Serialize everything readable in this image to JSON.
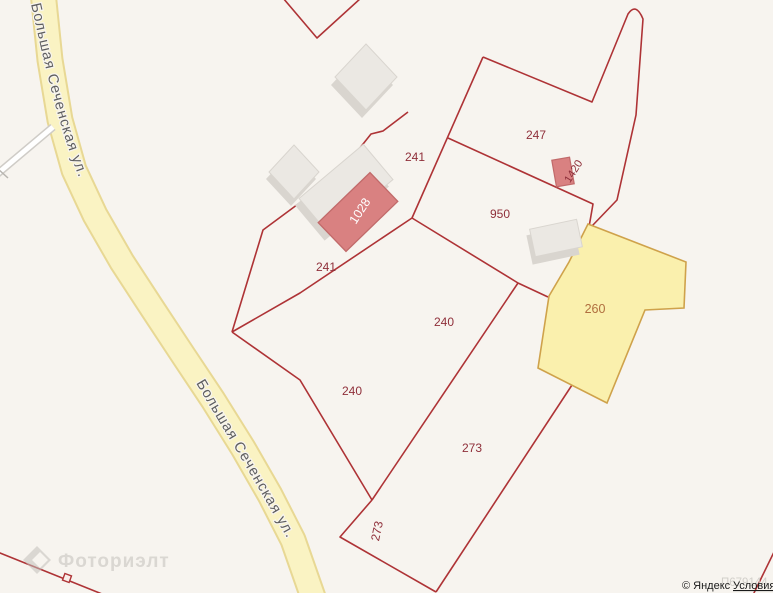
{
  "map": {
    "road_name": "Большая Сеченская ул.",
    "parcels": {
      "p247": "247",
      "p241_top": "241",
      "p950": "950",
      "p241_left": "241",
      "p240_mid": "240",
      "p240_low": "240",
      "p273_right": "273",
      "p273_left": "273",
      "p260": "260"
    },
    "buildings": {
      "b1028": "1028",
      "b1420": "1420"
    }
  },
  "watermark": {
    "brand": "Фоториэлт",
    "code": "П679144"
  },
  "attribution": {
    "copyright": "© Яндекс",
    "terms_link": "Условия"
  },
  "colors": {
    "background": "#f7f4ef",
    "parcel_line": "#ae3336",
    "parcel_label": "#8f2f3a",
    "selected_parcel_fill": "#faf0ad",
    "selected_parcel_border": "#cfa24b",
    "selected_parcel_label": "#b06f3f",
    "road_fill": "#faf3c3",
    "road_casing": "#e8d894",
    "side_road_fill": "#ffffff",
    "side_road_casing": "#cfccc7",
    "building_fill": "#ebe8e3",
    "building_shadow": "#d9d5cf",
    "highlight_building_fill": "#d98181",
    "highlight_building_border": "#c16a6a",
    "road_label_color": "#5e5e5e",
    "attribution_color": "#1a1a1a"
  }
}
